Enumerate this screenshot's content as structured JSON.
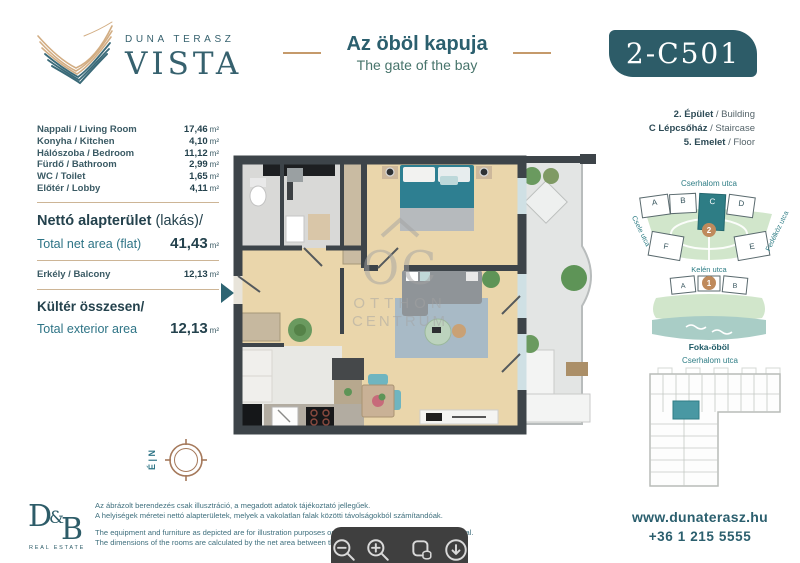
{
  "colors": {
    "teal_dark": "#2d5c68",
    "teal_text": "#2e7486",
    "tan_line": "#c59a6b",
    "highlight_unit": "#4998a3",
    "water": "#a9cdc6",
    "park_green": "#d1e6cb",
    "wall": "#3d4449"
  },
  "header": {
    "brand_top": "DUNA TERASZ",
    "brand_main": "VISTA",
    "title_hu": "Az öböl kapuja",
    "title_en": "The gate of the bay",
    "unit_code": "2-C501"
  },
  "rooms": {
    "items": [
      {
        "name": "Nappali / Living Room",
        "value": "17,46",
        "unit": "m²"
      },
      {
        "name": "Konyha / Kitchen",
        "value": "4,10",
        "unit": "m²"
      },
      {
        "name": "Hálószoba / Bedroom",
        "value": "11,12",
        "unit": "m²"
      },
      {
        "name": "Fürdő / Bathroom",
        "value": "2,99",
        "unit": "m²"
      },
      {
        "name": "WC / Toilet",
        "value": "1,65",
        "unit": "m²"
      },
      {
        "name": "Előtér / Lobby",
        "value": "4,11",
        "unit": "m²"
      }
    ],
    "net_label_hu": "Nettó alapterület",
    "net_label_hu_suffix": " (lakás)/",
    "net_label_en": "Total net area (flat)",
    "net_value": "41,43",
    "net_unit": "m²",
    "balcony_name": "Erkély / Balcony",
    "balcony_value": "12,13",
    "balcony_unit": "m²",
    "exterior_label_hu": "Kültér összesen/",
    "exterior_label_en": "Total exterior area",
    "exterior_value": "12,13",
    "exterior_unit": "m²"
  },
  "building_info": {
    "line1_bold": "2. Épület",
    "line1_rest": " / Building",
    "line2_bold": "C Lépcsőház",
    "line2_rest": " / Staircase",
    "line3_bold": "5. Emelet",
    "line3_rest": " / Floor"
  },
  "compass": {
    "label": "É | N"
  },
  "watermark": {
    "logo": "OC",
    "line1": "OTTHON",
    "line2": "CENTRUM"
  },
  "site_map": {
    "street_top": "Cserhalom utca",
    "street_left": "Csele utca",
    "street_right": "Fedélköz utca",
    "street_middle": "Kelén utca",
    "bay_label": "Foka-öböl",
    "top_blocks": [
      "A",
      "B",
      "C",
      "D"
    ],
    "mid_blocks": [
      "F",
      "E"
    ],
    "building2_number": "2",
    "building1_number": "1",
    "lower_blocks": [
      "A",
      "B"
    ]
  },
  "floor_map": {
    "street_top": "Cserhalom utca"
  },
  "footer": {
    "logo_d": "D",
    "logo_amp": "&",
    "logo_b": "B",
    "logo_tagline": "REAL ESTATE",
    "disclaimer_hu_1": "Az ábrázolt berendezés csak illusztráció, a megadott adatok tájékoztató jellegűek.",
    "disclaimer_hu_2": "A helyiségek méretei nettó alapterületek, melyek a vakolatlan falak közötti távolságokból számítandóak.",
    "disclaimer_en_1": "The equipment and furniture as depicted are for illustration purposes only. Any data given is strictly informational.",
    "disclaimer_en_2": "The dimensions of the rooms are calculated by the net area between the unplastered walls.",
    "website": "www.dunaterasz.hu",
    "phone": "+36 1 215 5555"
  },
  "toolbar": {
    "buttons": [
      "zoom-out-icon",
      "zoom-in-icon",
      "copy-image-icon",
      "download-icon"
    ]
  }
}
